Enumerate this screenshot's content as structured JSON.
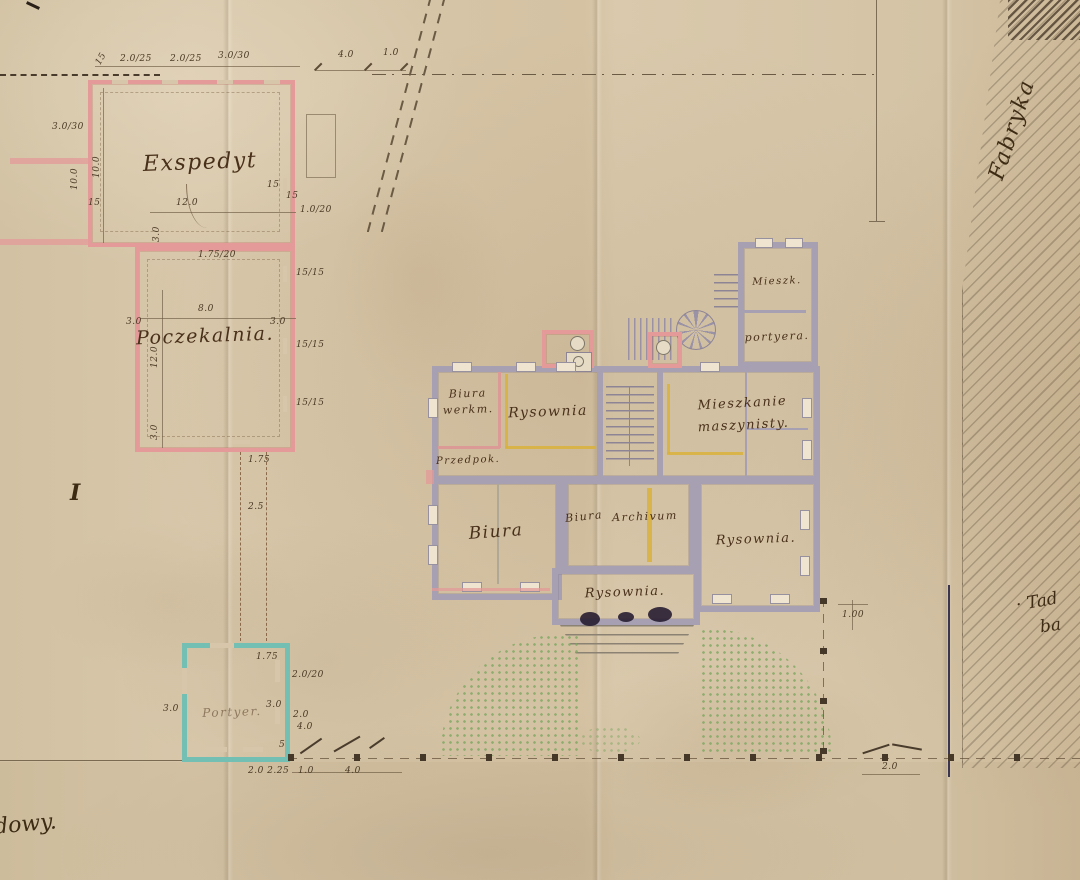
{
  "annotations": {
    "fabryka": "Fabryka",
    "signature_line1": "· Tad",
    "signature_line2": "ba",
    "corner_fragment": "dowy."
  },
  "rooms": {
    "exspedyt": "Exspedyt",
    "poczekalnia": "Poczekalnia.",
    "biura_werkm_1": "Biura",
    "biura_werkm_2": "werkm.",
    "rysownia_top": "Rysownia",
    "przedpok": "Przedpok.",
    "mieszkanie_1": "Mieszkanie",
    "mieszkanie_2": "maszynisty.",
    "mieszk": "Mieszk.",
    "portyera": "portyera.",
    "biura_large": "Biura",
    "biura_small": "Biura",
    "archivum": "Archivum",
    "rysownia_right": "Rysownia.",
    "rysownia_bottom": "Rysownia.",
    "portyer_lodge": "Portyer."
  },
  "marks": {
    "roman_one": "I"
  },
  "dims": [
    {
      "text": "15"
    },
    {
      "text": "2.0/25"
    },
    {
      "text": "2.0/25"
    },
    {
      "text": "3.0/30"
    },
    {
      "text": "4.0"
    },
    {
      "text": "1.0"
    },
    {
      "text": "3.0/30"
    },
    {
      "text": "10.0"
    },
    {
      "text": "10.0"
    },
    {
      "text": "15"
    },
    {
      "text": "12.0"
    },
    {
      "text": "3.0"
    },
    {
      "text": "15"
    },
    {
      "text": "15"
    },
    {
      "text": "1.0/20"
    },
    {
      "text": "1.75/20"
    },
    {
      "text": "15/15"
    },
    {
      "text": "8.0"
    },
    {
      "text": "3.0"
    },
    {
      "text": "3.0"
    },
    {
      "text": "15/15"
    },
    {
      "text": "12.0"
    },
    {
      "text": "15/15"
    },
    {
      "text": "3.0"
    },
    {
      "text": "1.75"
    },
    {
      "text": "2.5"
    },
    {
      "text": "1.75"
    },
    {
      "text": "2.0/20"
    },
    {
      "text": "3.0"
    },
    {
      "text": "2.0"
    },
    {
      "text": "4.0"
    },
    {
      "text": "3.0"
    },
    {
      "text": "2.0 2.25"
    },
    {
      "text": "1.0"
    },
    {
      "text": "4.0"
    },
    {
      "text": "1.00"
    },
    {
      "text": "2.0"
    },
    {
      "text": "5"
    }
  ],
  "colors": {
    "paper": "#d6c5a8",
    "ink_brown": "#49301a",
    "wall_pink": "#e39a98",
    "wall_teal": "#74bfb4",
    "wall_gray": "#a7a0b3",
    "new_wall_yellow": "#d9b23c",
    "garden_green": "#7fa863",
    "fence_dark": "#453828",
    "site_line_dark": "#3a3550"
  }
}
